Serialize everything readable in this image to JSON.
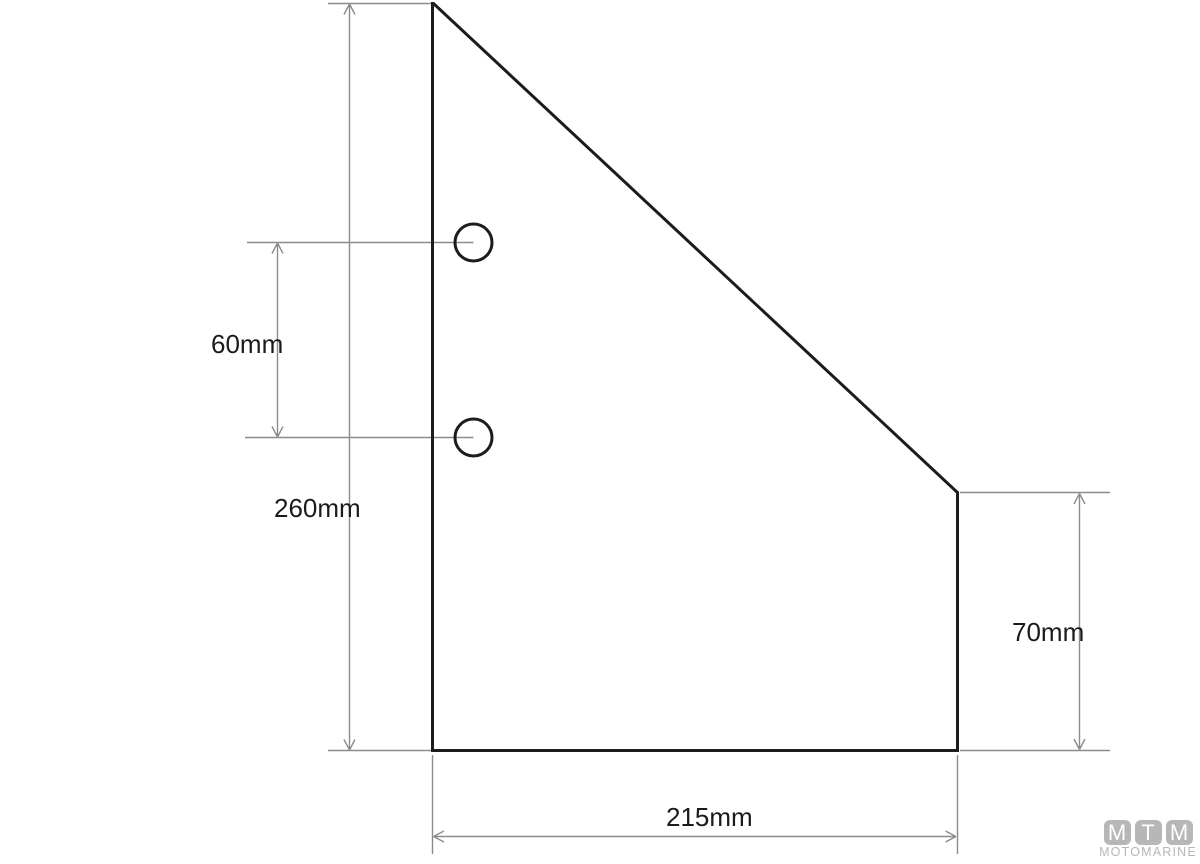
{
  "drawing": {
    "title_hint": "part-dimension-drawing",
    "colors": {
      "background": "#ffffff",
      "outline": "#1c1c1c",
      "dimension": "#8c8c8c",
      "label_text": "#1b1b1b",
      "logo_gray": "#b7b7b7"
    },
    "dimensions": {
      "hole_spacing": {
        "label": "60mm"
      },
      "left_height": {
        "label": "260mm"
      },
      "right_height": {
        "label": "70mm"
      },
      "bottom_width": {
        "label": "215mm"
      }
    },
    "paths": {
      "outline": "M432.5 3.5 L433.5 3.5 L957.5 492.5 L957.5 750.5 L432.5 750.5 Z",
      "holes": "M455 242.5 a18.5 18.5 0 1 0 37 0 a18.5 18.5 0 1 0 -37 0 M455 437.5 a18.5 18.5 0 1 0 37 0 a18.5 18.5 0 1 0 -37 0",
      "extension_lines": "M328 3.5 H432 M247 242.5 H473.5 M245 437.5 H473.5 M328 750.5 H432 M432.5 755 V854 M957.5 755 V854 M960 492.5 H1110 M960 750.5 H1110",
      "dim_left_height": "M349.5 4 V750 M349.5 4 l-5.5 10.5 M349.5 4 l5.5 10.5 M349.5 750 l-5.5 -10.5 M349.5 750 l5.5 -10.5",
      "dim_hole_spacing": "M277.5 243 V437 M277.5 243 l-5.5 10.5 M277.5 243 l5.5 10.5 M277.5 437 l-5.5 -10.5 M277.5 437 l5.5 -10.5",
      "dim_right_height": "M1079.5 493.5 V749.5 M1079.5 493.5 l-5.5 10.5 M1079.5 493.5 l5.5 10.5 M1079.5 749.5 l-5.5 -10.5 M1079.5 749.5 l5.5 -10.5",
      "dim_bottom_width": "M433.5 836.5 H956 M433.5 836.5 l10.5 -5.5 M433.5 836.5 l10.5 5.5 M956 836.5 l-10.5 -5.5 M956 836.5 l-10.5 5.5"
    },
    "stroke_widths": {
      "outline": "3",
      "dimension": "1.4"
    }
  },
  "logo": {
    "letters": {
      "first": "M",
      "second": "T",
      "third": "M"
    },
    "subtitle": "MOTOMARINE"
  }
}
